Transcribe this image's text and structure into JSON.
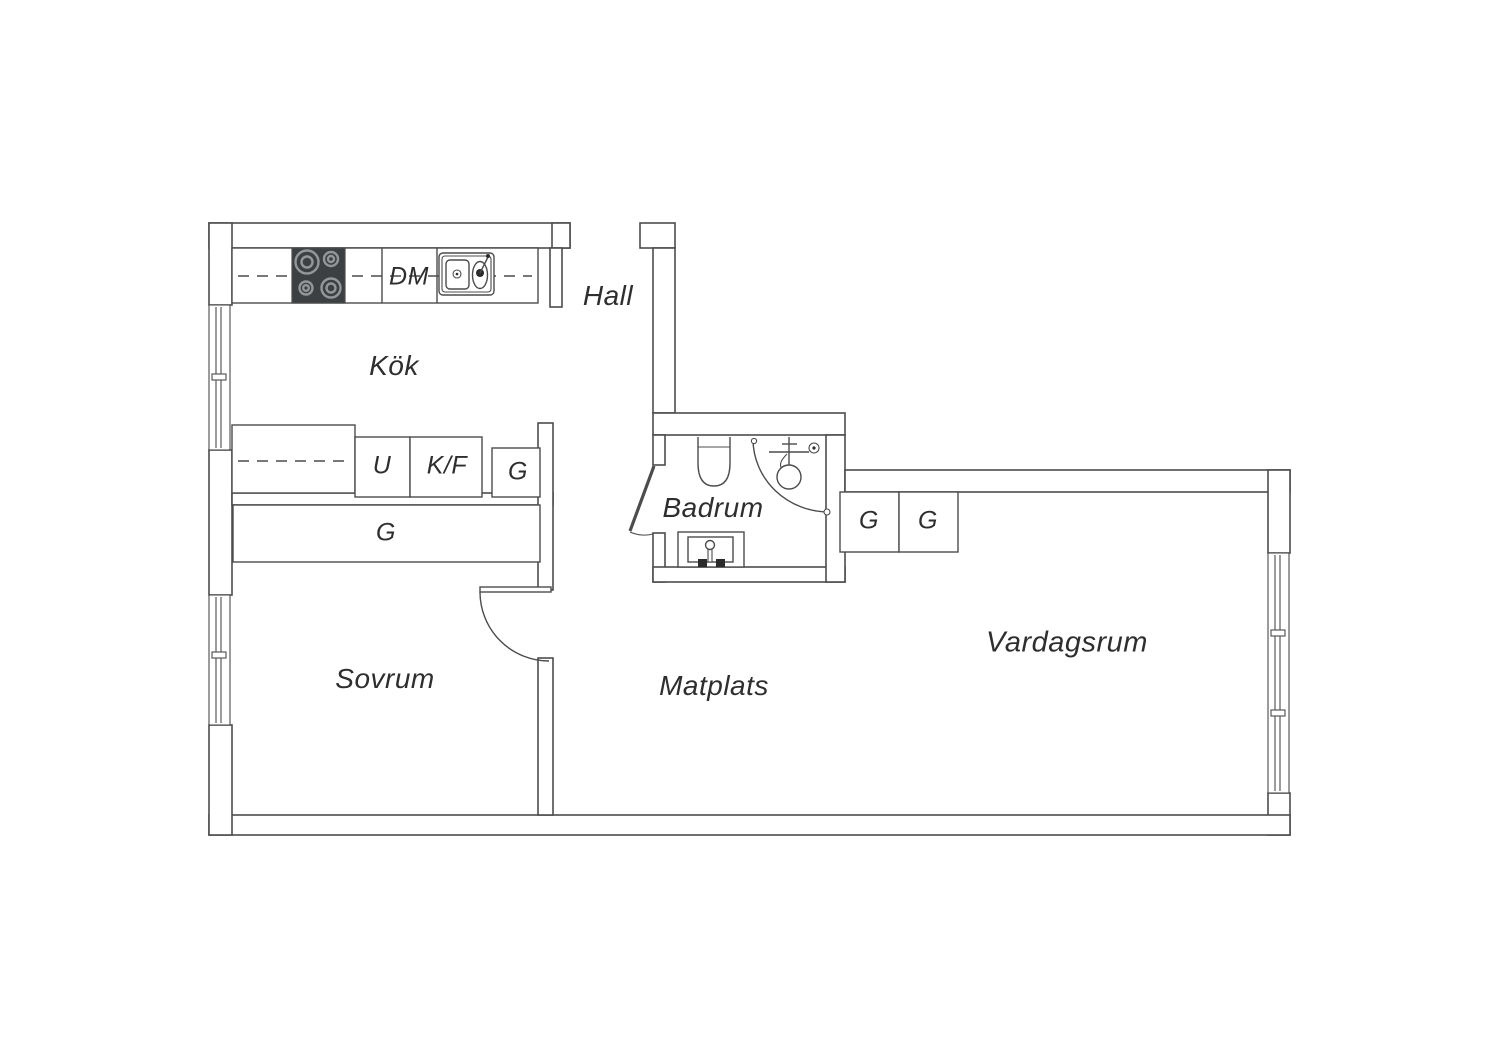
{
  "floorplan": {
    "rooms": {
      "hall": "Hall",
      "kitchen": "Kök",
      "bathroom": "Badrum",
      "bedroom": "Sovrum",
      "dining": "Matplats",
      "living": "Vardagsrum"
    },
    "fixtures": {
      "dishwasher": "DM",
      "undercounter_unit": "U",
      "fridge_freezer": "K/F",
      "wardrobe_kitchen": "G",
      "wardrobe_bedroom": "G",
      "wardrobe_hall_1": "G",
      "wardrobe_hall_2": "G"
    },
    "icons": [
      "stove-icon",
      "kitchen-sink-icon",
      "toilet-icon",
      "corner-shower-icon",
      "washbasin-icon",
      "window-icon",
      "door-swing-icon"
    ],
    "colors": {
      "line": "#4c4c4c",
      "text": "#2e2e2e",
      "stove_dark": "#3c4043",
      "burner_ring": "#949699",
      "background": "#ffffff"
    }
  }
}
